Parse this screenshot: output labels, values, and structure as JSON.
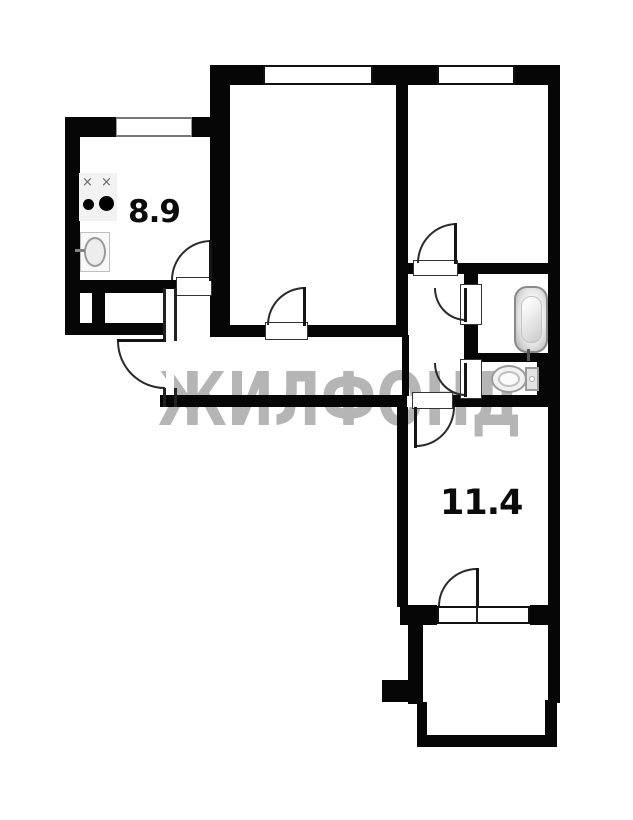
{
  "plan": {
    "title": "apartment-floor-plan",
    "watermark": "ЖИЛФОНД",
    "rooms": [
      {
        "name": "kitchen",
        "area_label": "8.9"
      },
      {
        "name": "living-room-lower",
        "area_label": "11.4"
      }
    ],
    "fixtures": [
      "stove",
      "sink",
      "bathtub",
      "toilet"
    ],
    "stove": {
      "burner_mark": "×"
    },
    "colors": {
      "wall": "#060606",
      "floor": "#ffffff",
      "watermark": "#b5b5b5",
      "fixture_outline": "#9a9a9a"
    }
  }
}
